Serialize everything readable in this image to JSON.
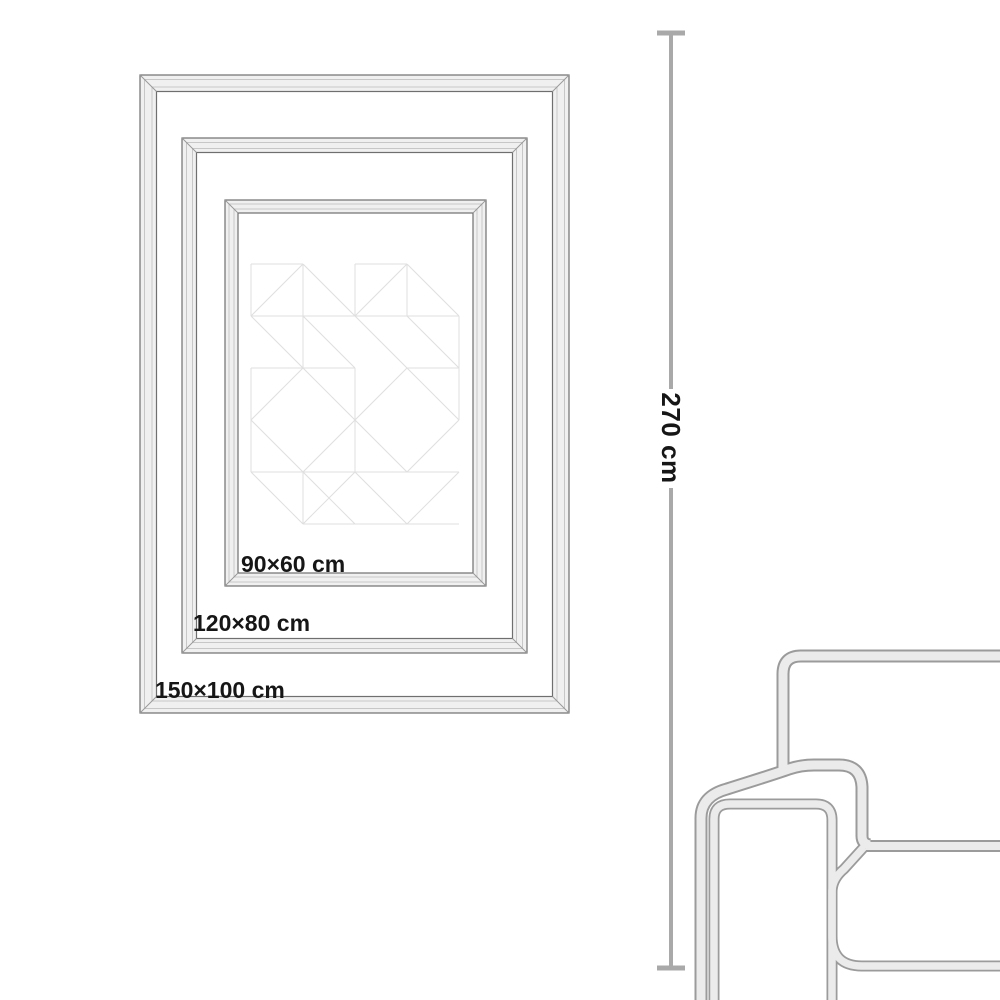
{
  "frames": [
    {
      "label": "150×100 cm",
      "width_cm": 150,
      "height_cm": 100
    },
    {
      "label": "120×80 cm",
      "width_cm": 120,
      "height_cm": 80
    },
    {
      "label": "90×60 cm",
      "width_cm": 90,
      "height_cm": 60
    }
  ],
  "height_dimension": {
    "label": "270 cm",
    "value_cm": 270
  },
  "colors": {
    "background": "#ffffff",
    "label_text": "#161616",
    "frame_fill": "#f0f0f0",
    "frame_edge": "#6f6f6f",
    "frame_bevel": "#c7c7c7",
    "frame_miter": "#9a9a9a",
    "pattern_line": "#dfdfdf",
    "dimension_line": "#a9a9a9",
    "sofa_edge": "#9b9b9b",
    "sofa_fill": "#ebebeb"
  }
}
